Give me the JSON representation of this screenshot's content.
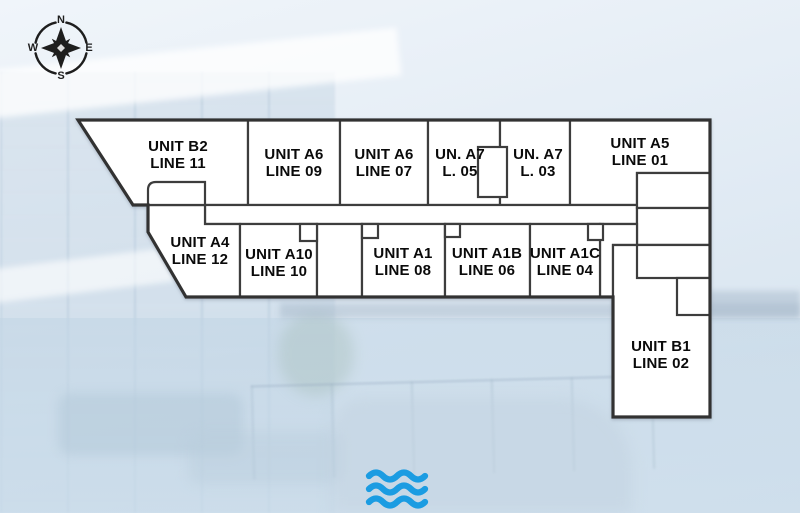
{
  "compass": {
    "north": "N",
    "east": "E",
    "south": "S",
    "west": "W"
  },
  "units": [
    {
      "name": "UNIT B2",
      "line": "LINE 11"
    },
    {
      "name": "UNIT A6",
      "line": "LINE 09"
    },
    {
      "name": "UNIT A6",
      "line": "LINE 07"
    },
    {
      "name": "UN. A7",
      "line": "L. 05"
    },
    {
      "name": "UN. A7",
      "line": "L. 03"
    },
    {
      "name": "UNIT A5",
      "line": "LINE 01"
    },
    {
      "name": "UNIT A4",
      "line": "LINE 12"
    },
    {
      "name": "UNIT A10",
      "line": "LINE 10"
    },
    {
      "name": "UNIT A1",
      "line": "LINE 08"
    },
    {
      "name": "UNIT A1B",
      "line": "LINE 06"
    },
    {
      "name": "UNIT A1C",
      "line": "LINE 04"
    },
    {
      "name": "UNIT B1",
      "line": "LINE 02"
    }
  ],
  "icons": {
    "compass": "compass-rose-icon",
    "water": "water-waves-icon"
  },
  "colors": {
    "wall": "#3d3d3d",
    "unit_fill": "#ffffff",
    "wave_blue": "#1b9ce2",
    "compass_ink": "#1e1e1e",
    "background_sky": "#dde8f2"
  }
}
